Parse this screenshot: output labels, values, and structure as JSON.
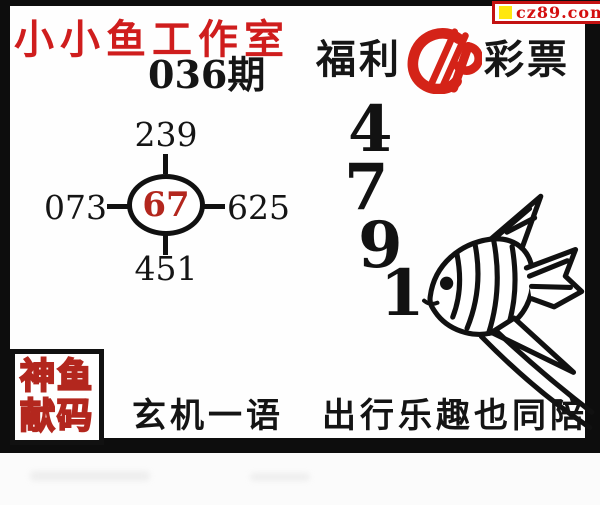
{
  "badge": {
    "text": "cz89.com"
  },
  "header": {
    "workshop": "小小鱼工作室",
    "issue": "036期"
  },
  "brand": {
    "prefix": "福利",
    "suffix": "彩票",
    "logo": "china-welfare-lottery-logo"
  },
  "diagram": {
    "center": "67",
    "top": "239",
    "left": "073",
    "right": "625",
    "bottom": "451"
  },
  "prediction_digits": [
    "4",
    "7",
    "9",
    "1"
  ],
  "stamp": {
    "line1": "神鱼",
    "line2": "献码"
  },
  "phrase": "玄机一语　出行乐趣也同陪",
  "colors": {
    "title_red": "#cf1d1d",
    "center_number_red": "#b3271e",
    "logo_red": "#d42318",
    "badge_border_red": "#c31212",
    "badge_text_red": "#d40f0f",
    "badge_yellow": "#ffe70f",
    "ink": "#111111",
    "frame_black": "#0d0d0d"
  }
}
